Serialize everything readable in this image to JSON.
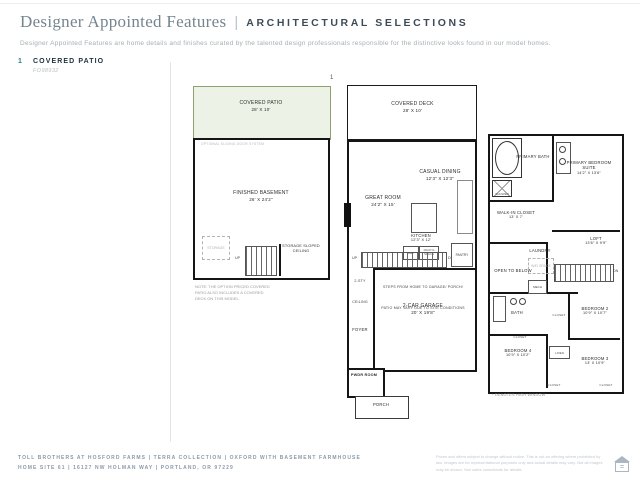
{
  "header": {
    "title": "Designer Appointed Features",
    "divider": "|",
    "subtitle_caps": "ARCHITECTURAL SELECTIONS",
    "description": "Designer Appointed Features are home details and finishes curated by the talented design professionals responsible for the distinctive looks found in our model homes."
  },
  "feature": {
    "number": "1",
    "label": "COVERED PATIO",
    "code": "FO98932"
  },
  "marker": "1",
  "plans": {
    "basement": {
      "patio_name": "COVERED PATIO",
      "patio_dims": "28' X 10'",
      "sliding_note": "OPTIONAL SLIDING DOOR SYSTEM",
      "room_name": "FINISHED BASEMENT",
      "room_dims": "26' X 24'2\"",
      "storage": "STORAGE",
      "up": "UP",
      "storage_sloped": "STORAGE SLOPED CEILING",
      "note": "NOTE: THE OPTION PRICED COVERED PATIO ALSO INCLUDES A COVERED DECK ON THIS MODEL."
    },
    "main": {
      "deck_name": "COVERED DECK",
      "deck_dims": "28' X 10'",
      "casual_name": "CASUAL DINING",
      "casual_dims": "12'3\" X 12'3\"",
      "great_name": "GREAT ROOM",
      "great_dims": "24'2\" X 15'",
      "kitchen_name": "KITCHEN",
      "kitchen_dims": "12'3\" X 12'",
      "ref": "REF",
      "packg": "PACK'G SPACE",
      "ceiling": "2-STY CEILING",
      "up": "UP",
      "dn": "DN",
      "pantry": "PANTRY",
      "steps_note": "STEPS FROM HOME TO GARAGE/ PORCH/ PATIO MAY VARY DUE TO SITE CONDITIONS",
      "garage_name": "2-CAR GARAGE",
      "garage_dims": "20' X 19'8\"",
      "foyer": "FOYER",
      "pwdr": "PWDR ROOM",
      "porch": "PORCH"
    },
    "upper": {
      "primary_bath": "PRIMARY BATH",
      "shower": "SHOWER",
      "primary_bed_name": "PRIMARY BEDROOM SUITE",
      "primary_bed_dims": "14'2\" X 13'6\"",
      "wic_name": "WALK-IN CLOSET",
      "wic_dims": "13' X 7'",
      "laundry": "LAUNDRY",
      "wd": "W/D SPACE",
      "loft_name": "LOFT",
      "loft_dims": "13'6\" X 9'9\"",
      "open_below": "OPEN TO BELOW",
      "mech": "MECH",
      "dn": "DN",
      "bath": "BATH",
      "closet": "CLOSET",
      "linen": "LINEN",
      "bed2_name": "BEDROOM 2",
      "bed2_dims": "10'9\" X 10'7\"",
      "bed3_name": "BEDROOM 3",
      "bed3_dims": "13' X 10'9\"",
      "bed4_name": "BEDROOM 4",
      "bed4_dims": "10'9\" X 10'2\"",
      "window_note": "* DENOTES HIGH WINDOW"
    }
  },
  "footer": {
    "line1": "TOLL BROTHERS AT HOSFORD FARMS  |  TERRA COLLECTION  |  OXFORD WITH BASEMENT FARMHOUSE",
    "line2": "HOME SITE 61  |  16127 NW HOLMAN WAY  |  PORTLAND, OR 97229",
    "disclaimer": "Prices and offers subject to change without notice. This is not an offering where prohibited by law. Images are for representational purposes only and actual details may vary. Not all images may be shown. See sales consultants for details."
  },
  "icons": {
    "equal_housing": "="
  },
  "colors": {
    "accent": "#2d7b86",
    "patio_fill": "#edf2e6",
    "patio_border": "#90a06e",
    "navy": "#21333f",
    "slate": "#8a9aa8"
  }
}
